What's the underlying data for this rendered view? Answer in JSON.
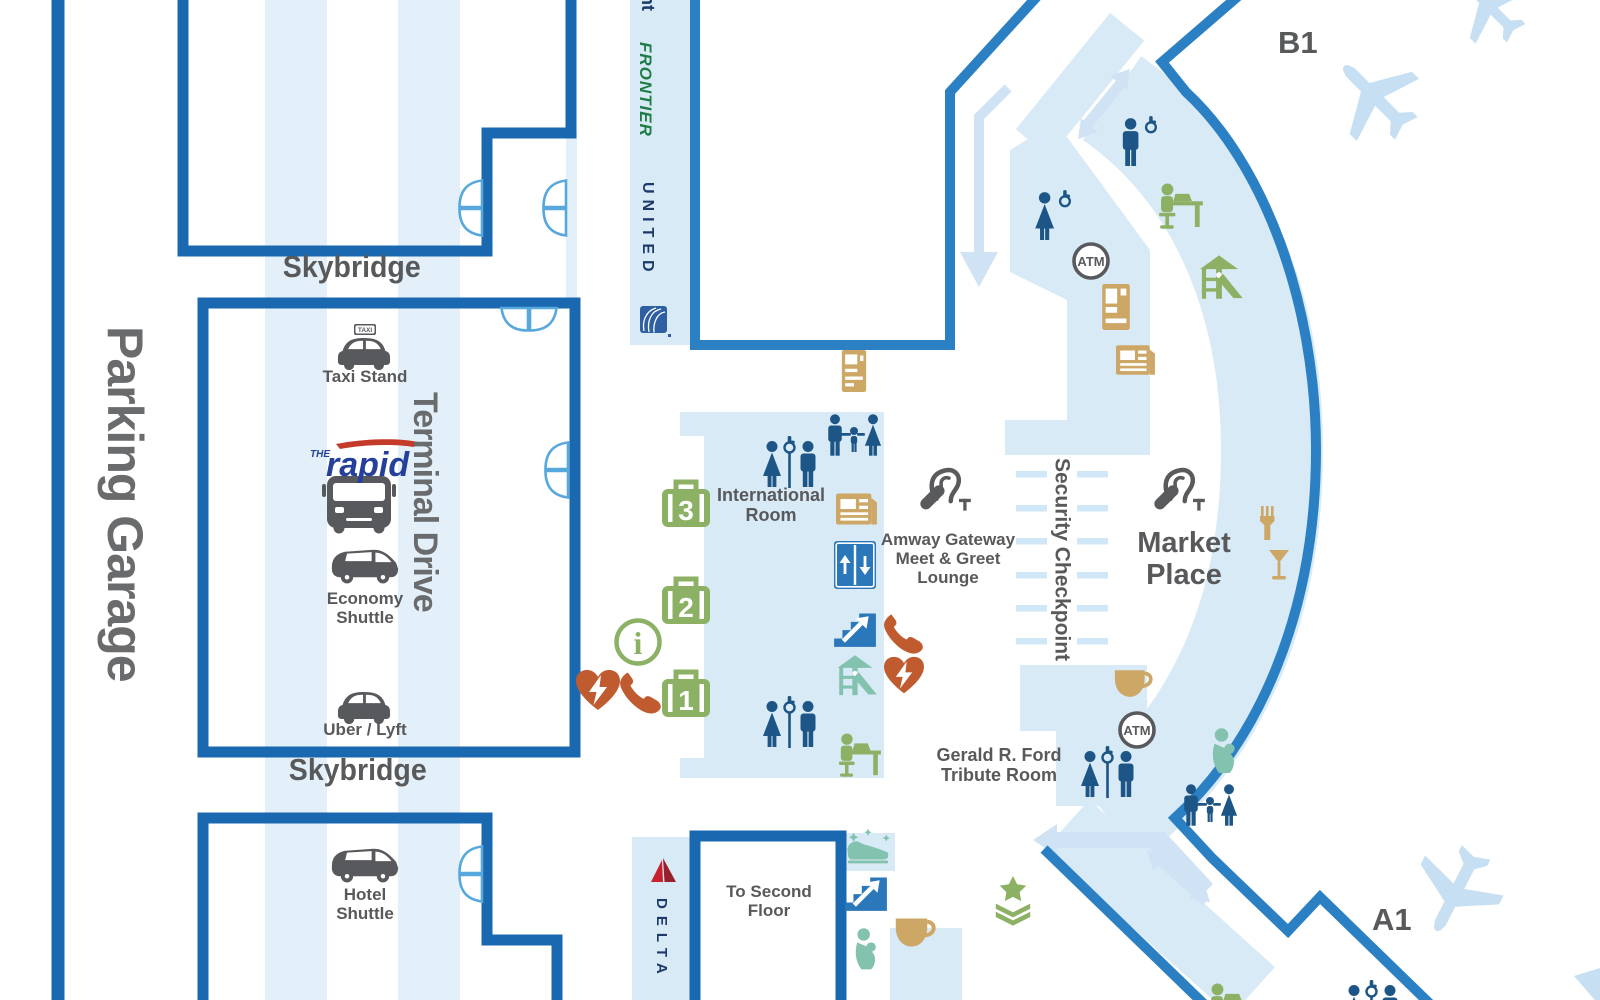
{
  "map": {
    "labels": {
      "parking_garage": "Parking Garage",
      "skybridge": "Skybridge",
      "terminal_drive": "Terminal Drive",
      "security_checkpoint": "Security Checkpoint",
      "international_room": [
        "International",
        "Room"
      ],
      "amway_lounge": [
        "Amway Gateway",
        "Meet & Greet",
        "Lounge"
      ],
      "market_place": [
        "Market",
        "Place"
      ],
      "gerald_ford": [
        "Gerald R. Ford",
        "Tribute Room"
      ],
      "to_second_floor": "To Second Floor"
    },
    "transport": {
      "taxi_stand": "Taxi Stand",
      "taxi_sign": "TAXI",
      "economy_shuttle": [
        "Economy",
        "Shuttle"
      ],
      "uber_lyft": "Uber / Lyft",
      "hotel_shuttle": [
        "Hotel",
        "Shuttle"
      ],
      "rapid_the": "THE",
      "rapid_name": "rapid"
    },
    "airlines": {
      "partial": "nt",
      "frontier": "FRONTIER",
      "united": "UNITED",
      "delta": "DELTA"
    },
    "gates": {
      "b1": "B1",
      "a1": "A1"
    },
    "amenities": {
      "atm": "ATM",
      "info": "i",
      "baggage_claims": [
        "3",
        "2",
        "1"
      ]
    },
    "icons": {
      "legend": [
        "taxi",
        "bus-rapid",
        "economy-shuttle-van",
        "uber-lyft-car",
        "hotel-shuttle-van",
        "baggage-claim",
        "information",
        "aed",
        "courtesy-phone",
        "elevator",
        "stairs-up",
        "restroom",
        "accessible",
        "family-restroom",
        "nursing-room",
        "play-area",
        "work-station",
        "vending",
        "newspapers",
        "check-in-kiosk",
        "coffee",
        "restaurant",
        "military-lounge",
        "shoe-shine",
        "hearing-loop",
        "atm",
        "airplane",
        "door"
      ]
    },
    "colors": {
      "wall_dark": "#1a69b0",
      "wall_medium": "#2b80c4",
      "room_fill": "#d9eaf7",
      "lane_stripe": "#e3f0fa",
      "arrow_light": "#cfe3f4",
      "icon_navy": "#1d5586",
      "icon_blue": "#2a77b9",
      "icon_green": "#8cb164",
      "icon_teal": "#83c2ae",
      "icon_orange": "#bf5b2f",
      "icon_tan": "#cda766",
      "icon_gray": "#58595c",
      "text_gray": "#58595b",
      "plane_blue": "#c6dff2",
      "united_navy": "#1b3a6b",
      "frontier_green": "#1e7d46",
      "rapid_blue": "#24409a",
      "delta_red": "#c8202f"
    }
  }
}
